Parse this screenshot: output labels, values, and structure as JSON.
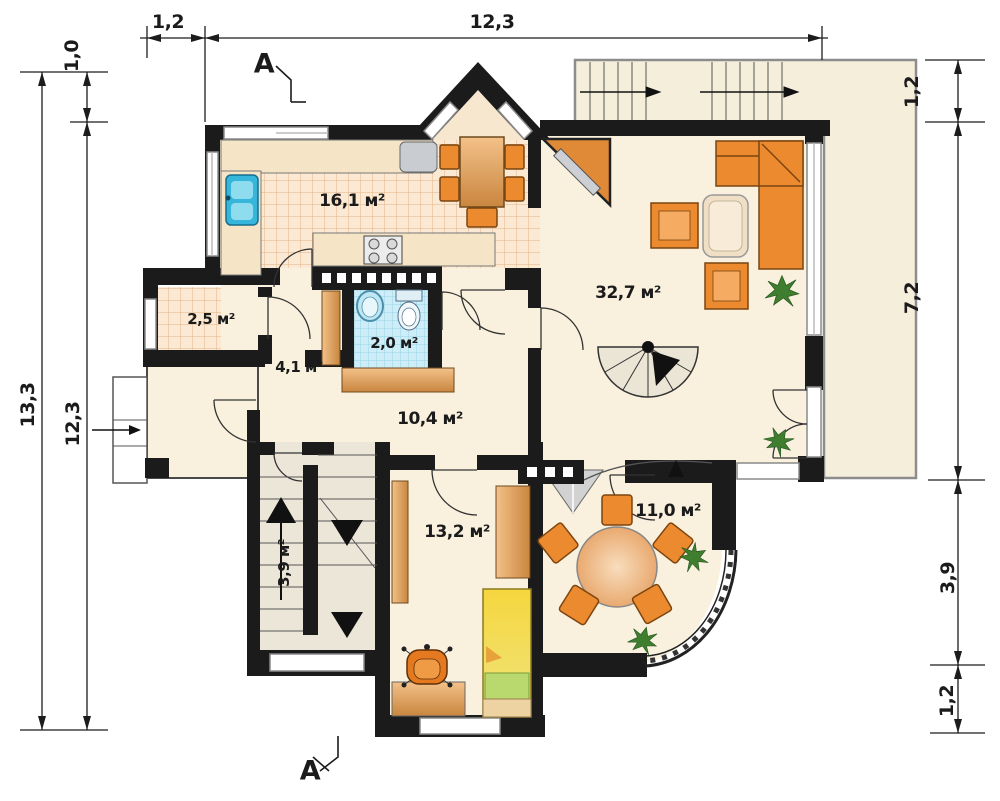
{
  "drawing_title": "first-floor-plan",
  "rooms": {
    "kitchen": "16,1 м²",
    "pantry": "2,5 м²",
    "bathroom": "2,0 м²",
    "hall": "4,1 м²",
    "corridor": "10,4 м²",
    "living": "32,7 м²",
    "stairs": "3,9 м²",
    "bedroom": "13,2 м²",
    "dining": "11,0 м²"
  },
  "dims": {
    "top": [
      "1,2",
      "12,3"
    ],
    "left": [
      "1,0",
      "13,3",
      "12,3"
    ],
    "right": [
      "1,2",
      "7,2",
      "3,9",
      "1,2"
    ]
  },
  "section": {
    "top": "A",
    "bottom": "A"
  },
  "colors": {
    "wall": "#1b1b1b",
    "floor": "#f9f1de",
    "kitchen_tile": "#fbe9d4",
    "bath_tile": "#cdeef8",
    "furniture_orange": "#ec8a2f",
    "wood": "#d8913f",
    "bed_yellow": "#f4d33c",
    "blanket_green": "#b9d96e",
    "terrace": "#f5eedb",
    "plant_green": "#3f7d2f",
    "sink_blue": "#35b6da"
  }
}
